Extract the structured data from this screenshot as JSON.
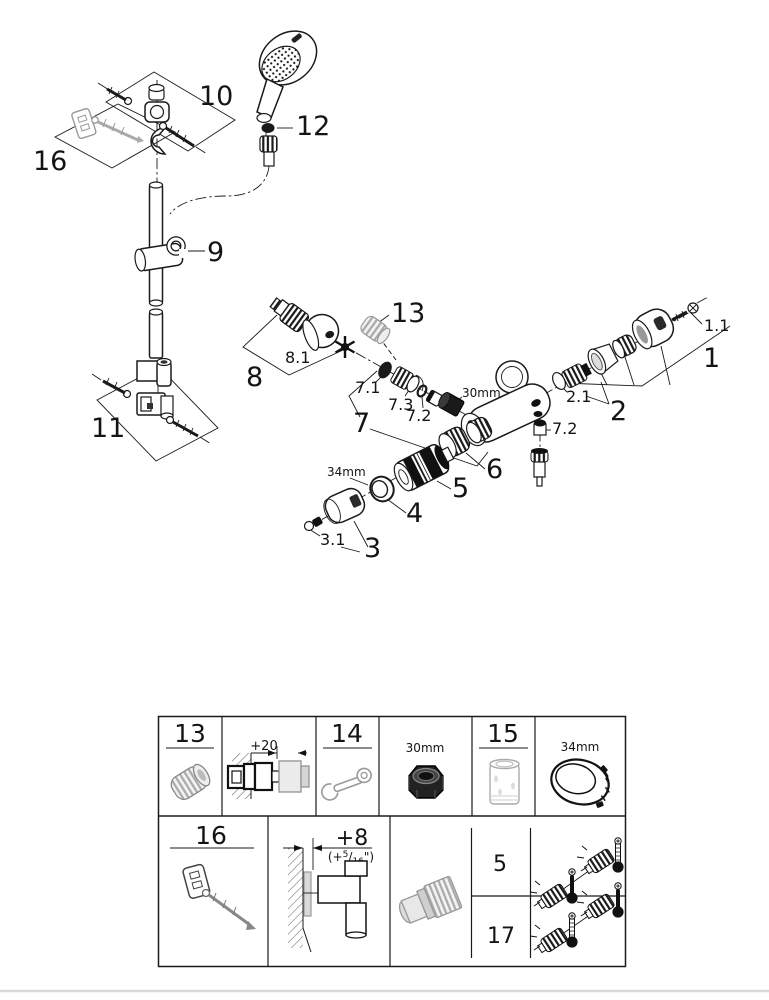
{
  "page": {
    "background": "#ffffff",
    "footer_rule_color": "#d9d9d9",
    "ink": "#1a1a1a",
    "gray_part": "#999999"
  },
  "diagram": {
    "callouts": {
      "n1": "1",
      "n1_1": "1.1",
      "n2": "2",
      "n2_1": "2.1",
      "n3": "3",
      "n3_1": "3.1",
      "n4": "4",
      "n5": "5",
      "n6": "6",
      "n7": "7",
      "n7_1": "7.1",
      "n7_2": "7.2",
      "n7_2b": "7.2",
      "n7_3": "7.3",
      "n8": "8",
      "n8_1": "8.1",
      "n9": "9",
      "n10": "10",
      "n11": "11",
      "n12": "12",
      "n13": "13",
      "n16": "16",
      "dim30": "30mm",
      "dim34": "34mm"
    },
    "icons": [
      "grease-star-icon",
      "hand-shower",
      "shower-rail",
      "mixer-body",
      "thermostat-cartridge"
    ]
  },
  "table": {
    "cells": {
      "c13": "13",
      "c14": "14",
      "c15": "15",
      "c16": "16",
      "c5": "5",
      "c17": "17"
    },
    "dims": {
      "plus20": "+20",
      "d30": "30mm",
      "d34": "34mm",
      "plus8": "+8",
      "inch_open": "(+",
      "inch_sup": "5",
      "inch_slash": "/",
      "inch_sub": "16",
      "inch_close": "\")"
    },
    "icons": [
      "stop-ring-icon",
      "wall-depth-diagram",
      "wrench-icon",
      "nut-30mm-icon",
      "cartridge-sleeve-icon",
      "ring-34mm-icon",
      "wall-plug-screw-icon",
      "wall-offset-diagram",
      "union-adapter-icon",
      "grease-tube-icon",
      "thermometer-icon"
    ]
  }
}
